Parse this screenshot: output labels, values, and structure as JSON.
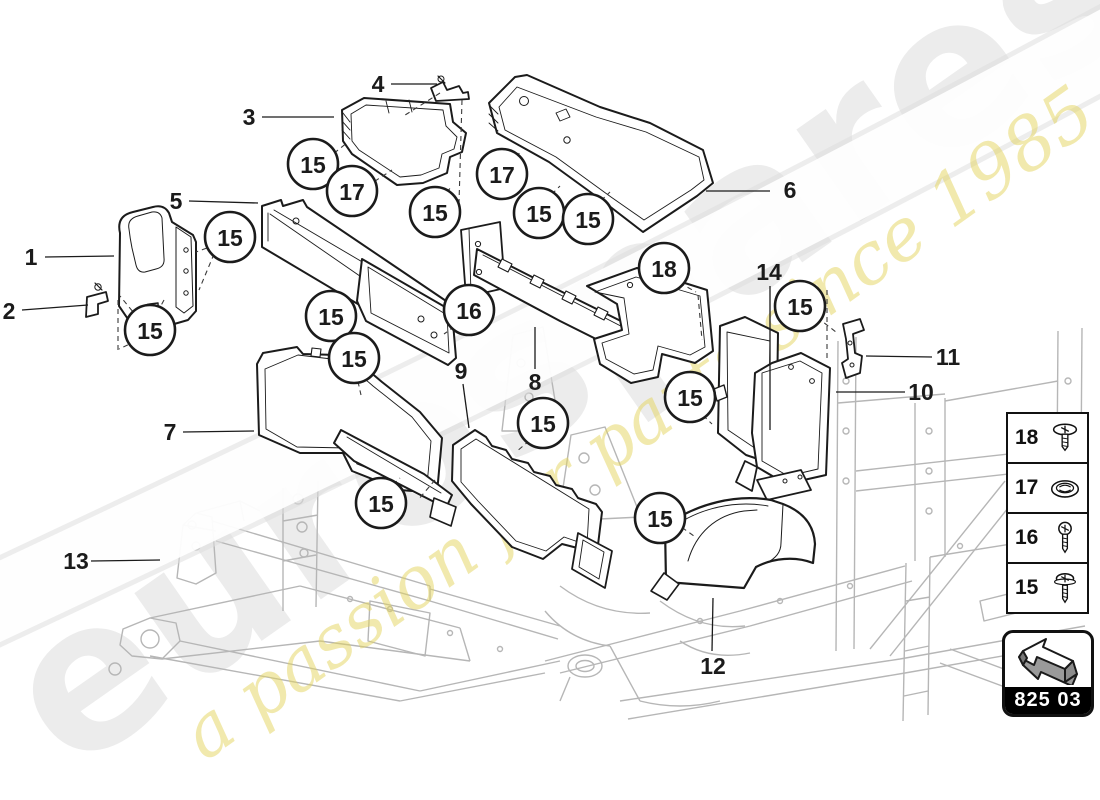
{
  "watermark": {
    "brand": "eurospares",
    "tagline": "a passion for parts since 1985",
    "brand_color": "#ececec",
    "tagline_color": "#e3d35b"
  },
  "diagram": {
    "callouts": [
      {
        "n": "15",
        "x": 230,
        "y": 237
      },
      {
        "n": "15",
        "x": 150,
        "y": 330
      },
      {
        "n": "15",
        "x": 313,
        "y": 164
      },
      {
        "n": "17",
        "x": 352,
        "y": 191
      },
      {
        "n": "15",
        "x": 435,
        "y": 212
      },
      {
        "n": "17",
        "x": 502,
        "y": 174
      },
      {
        "n": "15",
        "x": 539,
        "y": 213
      },
      {
        "n": "15",
        "x": 588,
        "y": 219
      },
      {
        "n": "18",
        "x": 664,
        "y": 268
      },
      {
        "n": "15",
        "x": 800,
        "y": 306
      },
      {
        "n": "16",
        "x": 469,
        "y": 310
      },
      {
        "n": "15",
        "x": 331,
        "y": 316
      },
      {
        "n": "15",
        "x": 354,
        "y": 358
      },
      {
        "n": "15",
        "x": 381,
        "y": 503
      },
      {
        "n": "15",
        "x": 543,
        "y": 423
      },
      {
        "n": "15",
        "x": 690,
        "y": 397
      },
      {
        "n": "15",
        "x": 660,
        "y": 518
      }
    ],
    "part_labels": [
      {
        "n": "1",
        "x": 31,
        "y": 257
      },
      {
        "n": "2",
        "x": 9,
        "y": 311
      },
      {
        "n": "3",
        "x": 249,
        "y": 117
      },
      {
        "n": "4",
        "x": 378,
        "y": 84
      },
      {
        "n": "5",
        "x": 176,
        "y": 201
      },
      {
        "n": "6",
        "x": 790,
        "y": 190
      },
      {
        "n": "7",
        "x": 170,
        "y": 432
      },
      {
        "n": "8",
        "x": 535,
        "y": 382
      },
      {
        "n": "9",
        "x": 461,
        "y": 371
      },
      {
        "n": "10",
        "x": 921,
        "y": 392
      },
      {
        "n": "11",
        "x": 948,
        "y": 357
      },
      {
        "n": "12",
        "x": 713,
        "y": 666
      },
      {
        "n": "13",
        "x": 76,
        "y": 561
      },
      {
        "n": "14",
        "x": 769,
        "y": 272
      }
    ],
    "leader_lines": [
      [
        45,
        257,
        114,
        256
      ],
      [
        22,
        310,
        88,
        305
      ],
      [
        262,
        117,
        334,
        117
      ],
      [
        391,
        84,
        437,
        84
      ],
      [
        189,
        201,
        258,
        203
      ],
      [
        706,
        191,
        770,
        191
      ],
      [
        183,
        432,
        254,
        431
      ],
      [
        535,
        369,
        535,
        327
      ],
      [
        463,
        384,
        469,
        428
      ],
      [
        836,
        392,
        905,
        392
      ],
      [
        866,
        356,
        932,
        357
      ],
      [
        712,
        651,
        713,
        598
      ],
      [
        91,
        561,
        160,
        560
      ],
      [
        770,
        286,
        770,
        430
      ]
    ],
    "dashed_lines": [
      [
        215,
        245,
        196,
        252
      ],
      [
        214,
        254,
        199,
        290
      ],
      [
        138,
        318,
        120,
        296
      ],
      [
        136,
        341,
        119,
        349
      ],
      [
        118,
        300,
        118,
        350
      ],
      [
        313,
        170,
        348,
        142
      ],
      [
        352,
        196,
        392,
        170
      ],
      [
        435,
        206,
        452,
        186
      ],
      [
        462,
        100,
        459,
        203
      ],
      [
        440,
        93,
        402,
        117
      ],
      [
        502,
        180,
        520,
        152
      ],
      [
        539,
        207,
        560,
        186
      ],
      [
        588,
        213,
        610,
        192
      ],
      [
        664,
        274,
        696,
        292
      ],
      [
        698,
        295,
        702,
        340
      ],
      [
        810,
        312,
        836,
        332
      ],
      [
        827,
        290,
        827,
        358
      ],
      [
        469,
        316,
        444,
        334
      ],
      [
        331,
        322,
        338,
        356
      ],
      [
        354,
        364,
        361,
        395
      ],
      [
        380,
        497,
        400,
        478
      ],
      [
        543,
        429,
        516,
        452
      ],
      [
        690,
        403,
        712,
        424
      ],
      [
        660,
        512,
        694,
        536
      ],
      [
        164,
        300,
        148,
        330
      ],
      [
        435,
        480,
        418,
        500
      ]
    ]
  },
  "legend": {
    "items": [
      {
        "number": "18",
        "icon": "washer-screw"
      },
      {
        "number": "17",
        "icon": "grommet-nut"
      },
      {
        "number": "16",
        "icon": "button-screw"
      },
      {
        "number": "15",
        "icon": "pan-screw"
      }
    ]
  },
  "code_box": {
    "label": "825 03"
  },
  "colors": {
    "line": "#1b1b1b",
    "chassis": "#b6b6b6",
    "white": "#ffffff"
  }
}
